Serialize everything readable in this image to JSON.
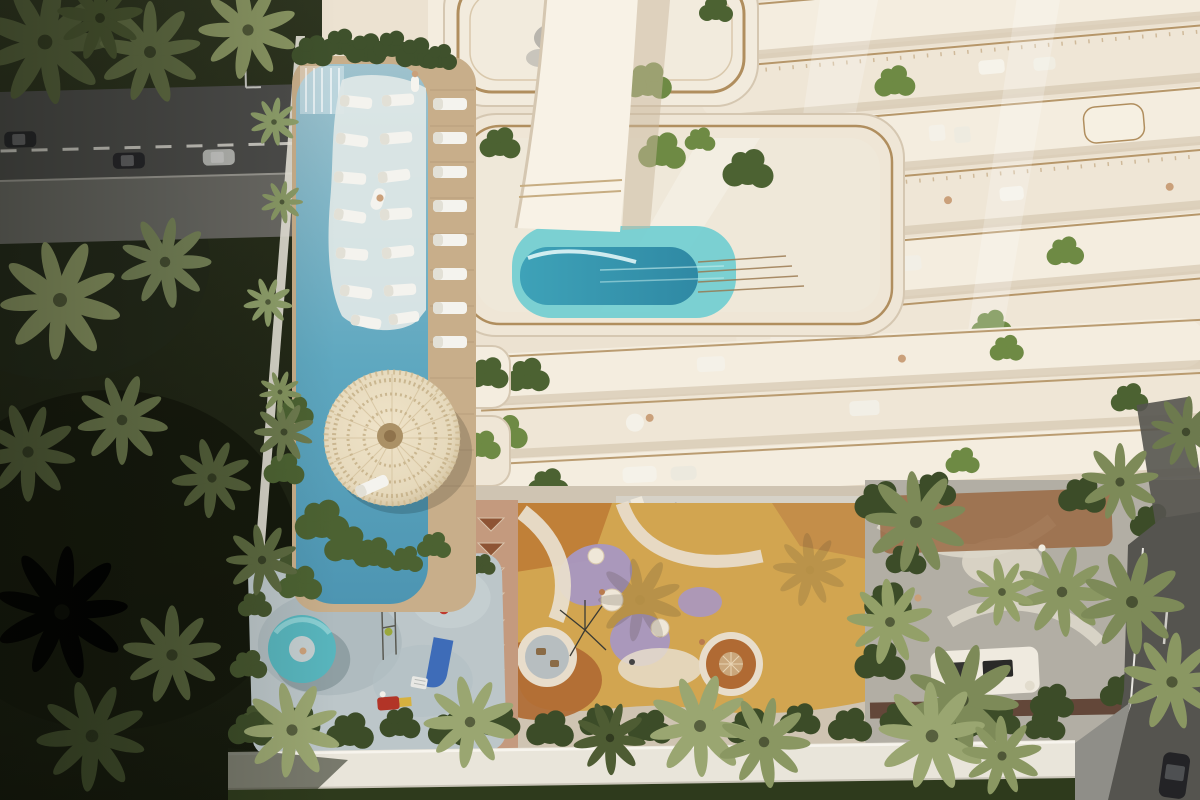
{
  "scene": {
    "kind": "aerial-architectural-render",
    "palette": {
      "jungleTop": "#2e3520",
      "jungleBottom": "#14180c",
      "canopy": "#55613b",
      "canopyLight": "#8a9663",
      "canopyPale": "#9aa671",
      "lawn": "#2e3a1c",
      "roadAsphalt": "#4c4c4a",
      "sidewalk": "#6e6d68",
      "roadLine": "#d9d7d0",
      "carDark": "#26262a",
      "carSilver": "#b7b8b4",
      "wallWhite": "#e9e5da",
      "poolLight": "#9fc2cd",
      "poolMain": "#5fa8c0",
      "poolDeep": "#4d95b2",
      "ledgeWhite": "#dfe7e6",
      "deckWood": "#c8ae8a",
      "cream": "#ece2d1",
      "creamLight": "#f4eddf",
      "creamBand": "#efe6d6",
      "creamShade": "#d5c7b1",
      "gold": "#b08e5e",
      "goldDark": "#97754a",
      "plant": "#4c6232",
      "plantLight": "#6e8a44",
      "plantDark": "#3c4c28",
      "aquaLedge": "#74cfd2",
      "aquaMid": "#3ea2b8",
      "aquaDeep": "#2f89a4",
      "parasol": "#e6d9bc",
      "parasolEdge": "#cdbb97",
      "parasolKnob": "#ab9166",
      "walkway": "#c49a7e",
      "triangle": "#8e5434",
      "mustard": "#d2a550",
      "mustardDark": "#c08038",
      "rust": "#b06a33",
      "lavender": "#a897c1",
      "sand": "#e8ddcb",
      "cafeFloor": "#d6d2c8",
      "shadowWarm": "#7d7668",
      "brownDeck": "#96603a",
      "darkBrown": "#5a3c2e",
      "paving": "#b2aea4",
      "pavingLight": "#d8d3c6",
      "bbqWhite": "#efeadf",
      "grill": "#333330",
      "splash": "#bcc6c9",
      "splashShade": "#a7b4b9",
      "donut": "#58b5bd",
      "slideBlue": "#3e6cb8",
      "red": "#bf3a2e",
      "yellow": "#d6b13f",
      "skinTan": "#caa07a",
      "white": "#f2f1ec"
    },
    "elements": {
      "road_top_left": {
        "cars": 3,
        "lane_dashes": true
      },
      "lap_pool": {
        "in_pool_loungers": 14,
        "deck_loungers": 8,
        "waterfall": true,
        "floating_person": 1
      },
      "round_parasol": 1,
      "building": {
        "rooftop_pool": 1,
        "white_chute": 1,
        "upper_balcony_bands": 6,
        "lower_balcony_bands": 4,
        "terrace_plants": true
      },
      "playground": {
        "play_rings": 2,
        "domes": 3,
        "lavender_patches": 3
      },
      "walkway_triangles": 8,
      "cafe_terrace": {
        "tables": 3
      },
      "garden_terrace": {
        "bbq_island": 1,
        "palms": true
      },
      "splash_pad": {
        "donut_slide": 1,
        "blue_slide": 1,
        "red_floats": 2,
        "play_frame": 1
      },
      "perimeter_wall": true,
      "right_road": {
        "cars": 1
      }
    }
  }
}
